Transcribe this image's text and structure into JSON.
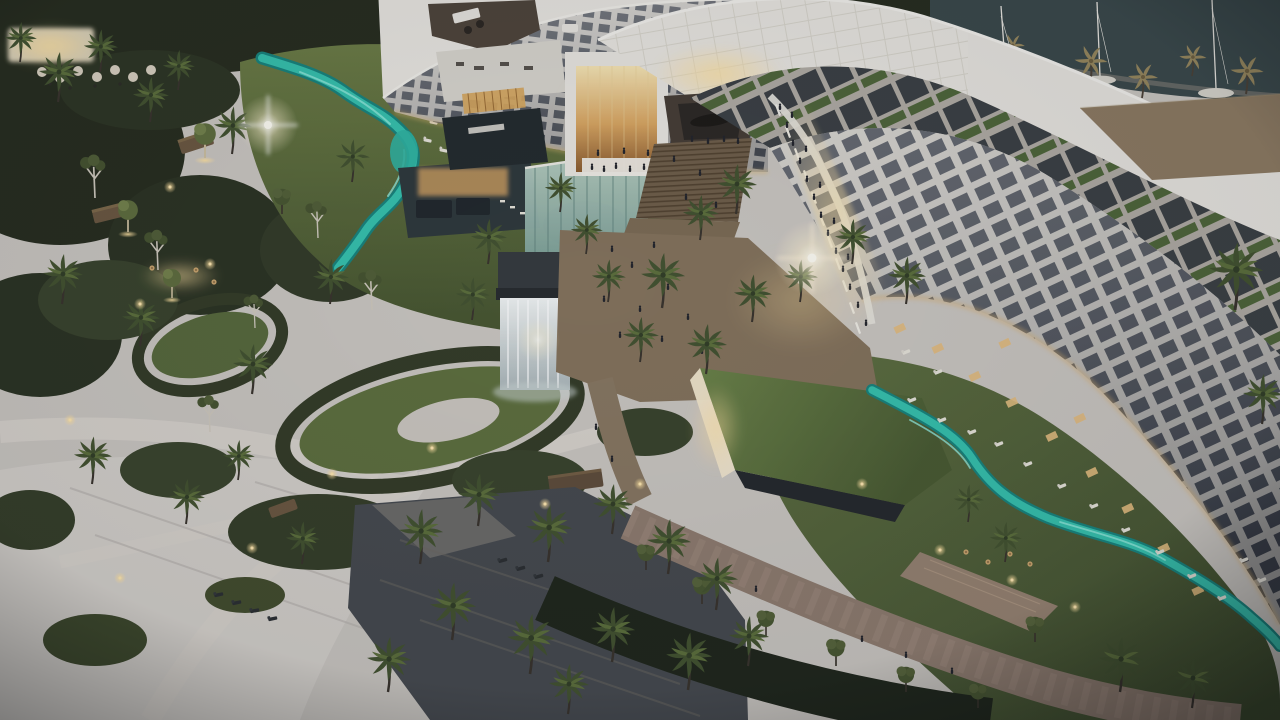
{
  "image": {
    "kind": "aerial architectural rendering",
    "subject": "luxury beachfront resort complex at dusk",
    "visible_text": [],
    "time_of_day": "dusk with warm artificial lighting"
  },
  "palette": {
    "sand": "#cbc6c0",
    "sandLight": "#d6d2cc",
    "canopyDark": "#262c1d",
    "shrub": "#38422a",
    "lawn": "#5e6f3c",
    "lawnDeep": "#46542e",
    "buildingWhite": "#dcd8d1",
    "roofWhite": "#eae7e0",
    "windowDark": "#474b53",
    "windowLit": "#e5c286",
    "river": "#38c3af",
    "riverDeep": "#1c8f85",
    "marina": "#3a4849",
    "paver": "#8f7c6a",
    "steps": "#6e5d47",
    "pool": "#45494d",
    "hedge": "#20261b",
    "glow": "#f6dfa6",
    "flare": "#fff6e6",
    "person": "#222329",
    "arcade": "#e8c387"
  },
  "scene": {
    "regions": [
      {
        "name": "left-wing-building",
        "description": "curved white hotel wing with window grid and tiered rooftop terraces"
      },
      {
        "name": "atrium-lobby",
        "description": "glowing amber glass atrium tower at center"
      },
      {
        "name": "canopy-roof",
        "description": "sweeping white gridded canopy bridging to right wing"
      },
      {
        "name": "right-wing-building",
        "description": "crescent wing with diagonal rooftop terrace panels, green walls and balcony facade"
      },
      {
        "name": "marina",
        "description": "dock water with white sailboat masts, top right"
      },
      {
        "name": "lazy-river-left",
        "description": "turquoise stream winding along left wing base"
      },
      {
        "name": "lazy-river-right",
        "description": "turquoise lazy river crossing right lawn"
      },
      {
        "name": "grand-steps-promenade",
        "description": "central staircase and paved promenade with crowds and palms"
      },
      {
        "name": "waterfall-feature",
        "description": "white cascading waterfall wall and teal glass water curtain"
      },
      {
        "name": "green-roof-pavilion",
        "description": "grass-roofed pavilion with glowing lit face"
      },
      {
        "name": "garden-plaza",
        "description": "sandy plaza with organic hedge rings, paths, pergolas, bottom left"
      },
      {
        "name": "palm-grove-pool",
        "description": "dark reflecting pool with palms and loungers, bottom center"
      },
      {
        "name": "promenade-bottom-right",
        "description": "stone walk, hedges, cafe tables, tiled canopy"
      }
    ],
    "lighting": [
      "lens flares",
      "warm path lamps",
      "lit restaurant terraces",
      "uplit trees"
    ]
  }
}
